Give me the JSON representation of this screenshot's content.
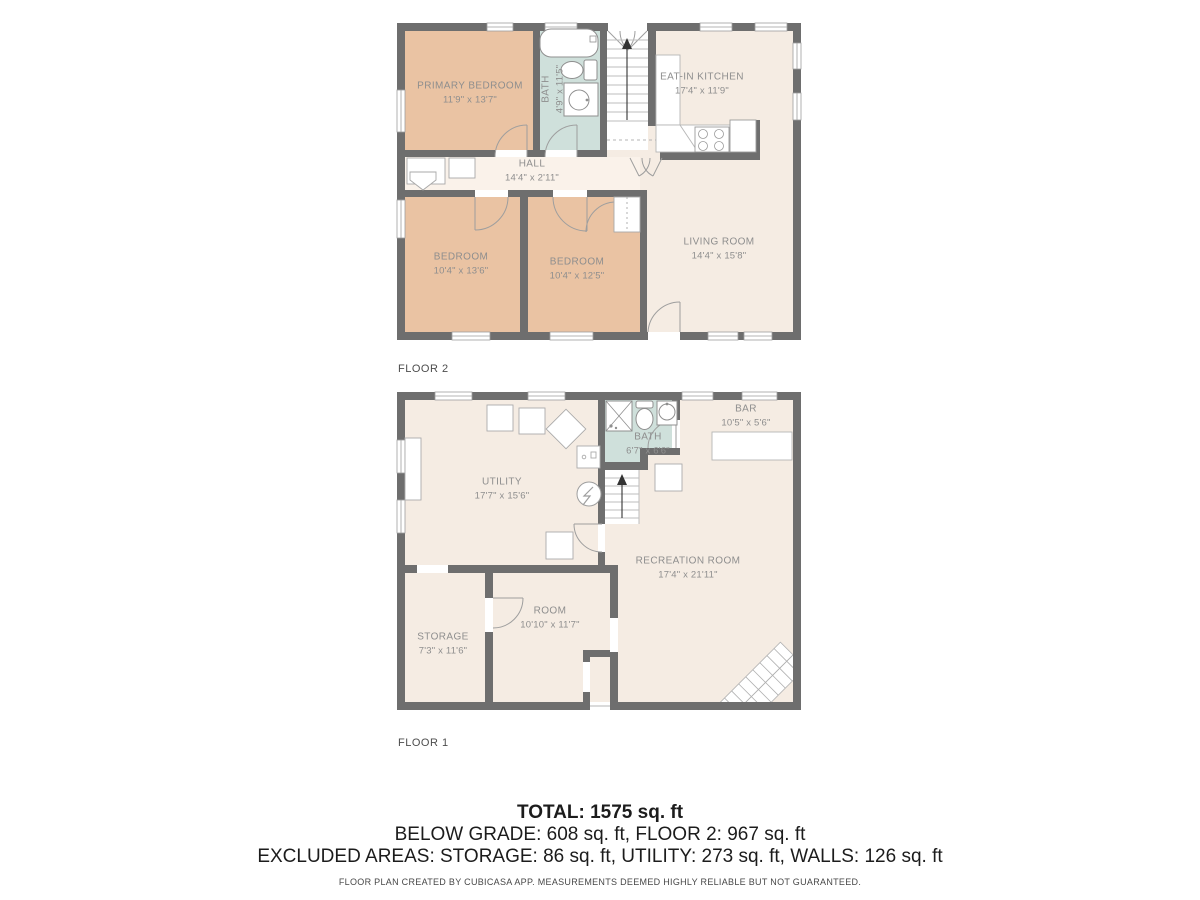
{
  "colors": {
    "wall": "#6e6e6e",
    "bedroom_fill": "#eac3a3",
    "room_fill": "#f5ece3",
    "hall_fill": "#faf2ea",
    "bath_fill": "#cfe0db",
    "room_label_text": "#8e8e8e",
    "floor_label_text": "#4d4d4d",
    "summary_text": "#1c1c1c"
  },
  "floor2": {
    "label": "FLOOR 2",
    "rooms": {
      "primary_bedroom": {
        "name": "PRIMARY BEDROOM",
        "dims": "11'9\" x 13'7\""
      },
      "bath": {
        "name": "BATH",
        "dims": "4'9\" x 11'5\""
      },
      "eat_in_kitchen": {
        "name": "EAT-IN KITCHEN",
        "dims": "17'4\" x 11'9\""
      },
      "hall": {
        "name": "HALL",
        "dims": "14'4\" x 2'11\""
      },
      "bedroom_left": {
        "name": "BEDROOM",
        "dims": "10'4\" x 13'6\""
      },
      "bedroom_middle": {
        "name": "BEDROOM",
        "dims": "10'4\" x 12'5\""
      },
      "living_room": {
        "name": "LIVING ROOM",
        "dims": "14'4\" x 15'8\""
      }
    }
  },
  "floor1": {
    "label": "FLOOR 1",
    "rooms": {
      "utility": {
        "name": "UTILITY",
        "dims": "17'7\" x 15'6\""
      },
      "bath": {
        "name": "BATH",
        "dims": "6'7\" x 6'6\""
      },
      "bar": {
        "name": "BAR",
        "dims": "10'5\" x 5'6\""
      },
      "recreation_room": {
        "name": "RECREATION ROOM",
        "dims": "17'4\" x 21'11\""
      },
      "storage": {
        "name": "STORAGE",
        "dims": "7'3\" x 11'6\""
      },
      "room": {
        "name": "ROOM",
        "dims": "10'10\" x 11'7\""
      }
    }
  },
  "summary": {
    "total": "TOTAL: 1575 sq. ft",
    "below_grade": "BELOW GRADE: 608 sq. ft, FLOOR 2: 967 sq. ft",
    "excluded": "EXCLUDED AREAS: STORAGE: 86 sq. ft, UTILITY: 273 sq. ft, WALLS: 126 sq. ft"
  },
  "footer": {
    "text": "FLOOR PLAN CREATED BY CUBICASA APP. MEASUREMENTS DEEMED HIGHLY RELIABLE BUT NOT GUARANTEED."
  }
}
